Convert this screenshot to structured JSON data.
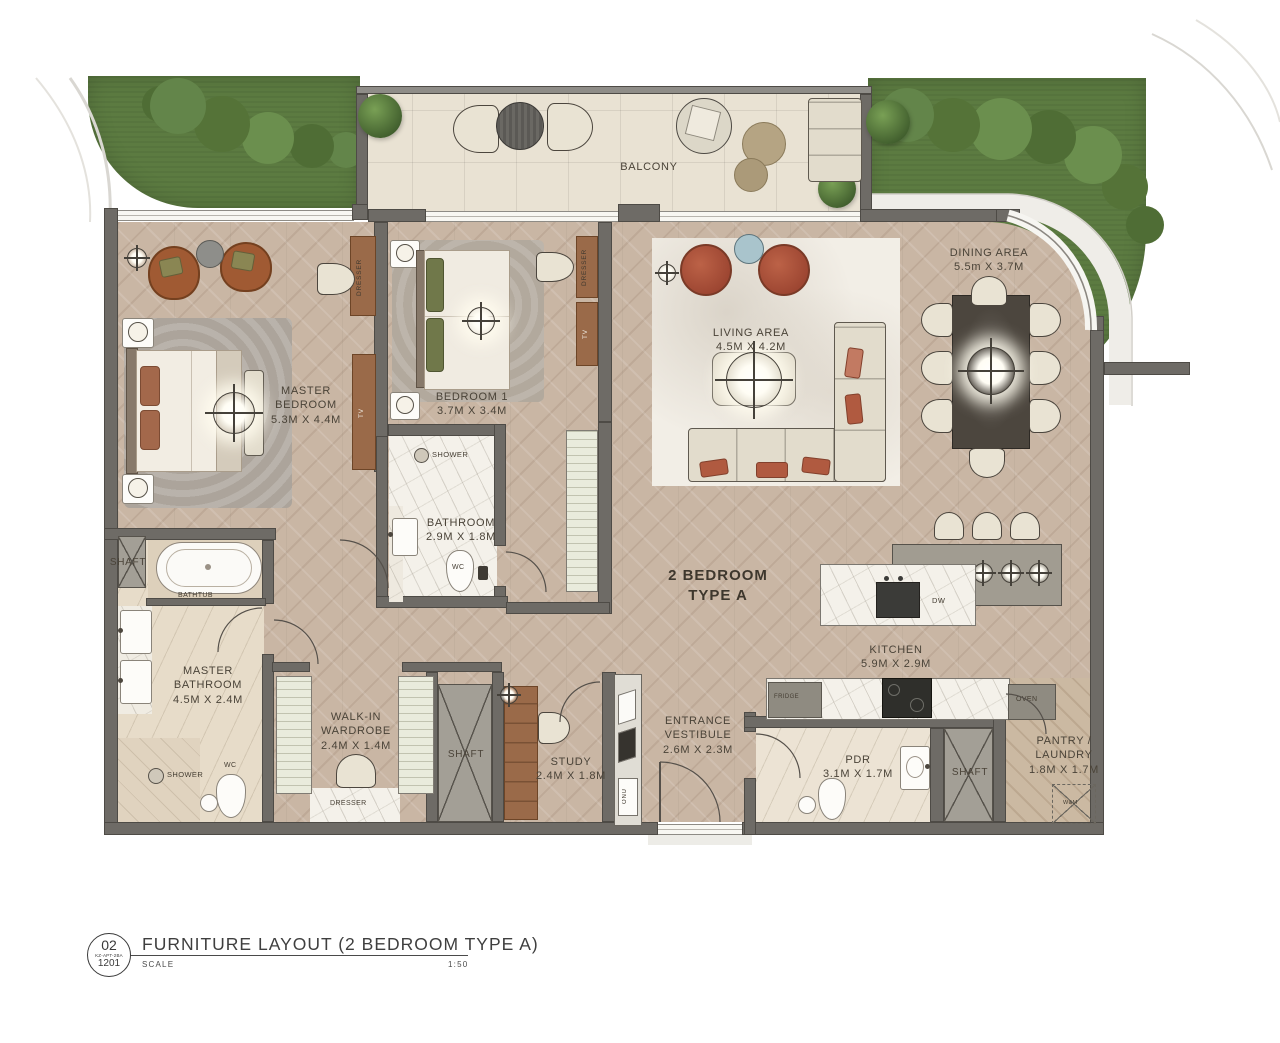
{
  "unit": {
    "type_label": "2 BEDROOM TYPE A"
  },
  "rooms": {
    "balcony": {
      "name": "BALCONY"
    },
    "master_bedroom": {
      "name": "MASTER BEDROOM",
      "dims": "5.3M X 4.4M"
    },
    "bedroom_1": {
      "name": "BEDROOM 1",
      "dims": "3.7M X 3.4M"
    },
    "living_area": {
      "name": "LIVING AREA",
      "dims": "4.5M X 4.2M"
    },
    "dining_area": {
      "name": "DINING AREA",
      "dims": "5.5m X 3.7M"
    },
    "bathroom": {
      "name": "BATHROOM",
      "dims": "2.9M X 1.8M"
    },
    "kitchen": {
      "name": "KITCHEN",
      "dims": "5.9M X 2.9M"
    },
    "master_bathroom": {
      "name": "MASTER BATHROOM",
      "dims": "4.5M X 2.4M"
    },
    "walk_in_wardrobe": {
      "name": "WALK-IN WARDROBE",
      "dims": "2.4M X 1.4M"
    },
    "study": {
      "name": "STUDY",
      "dims": "2.4M X 1.8M"
    },
    "entrance_vestibule": {
      "name": "ENTRANCE VESTIBULE",
      "dims": "2.6M X 2.3M"
    },
    "pdr": {
      "name": "PDR",
      "dims": "3.1M X 1.7M"
    },
    "pantry_laundry": {
      "name": "PANTRY / LAUNDRY",
      "dims": "1.8M X 1.7M"
    },
    "shaft": {
      "name": "SHAFT"
    }
  },
  "fixtures": {
    "shower": "SHOWER",
    "wc": "WC",
    "bathtub": "BATHTUB",
    "dresser": "DRESSER",
    "tv": "TV",
    "fridge": "FRIDGE",
    "oven": "OVEN",
    "dishwasher": "DW",
    "washing_machine": "W&M",
    "onu": "ONU"
  },
  "title_block": {
    "sheet_number": "02",
    "project_code": "KZ-APT-2BA",
    "unit_number": "1201",
    "title": "FURNITURE LAYOUT (2 BEDROOM TYPE A)",
    "scale_label": "SCALE",
    "scale_value": "1:50"
  },
  "colors": {
    "wall": "#6e6b66",
    "wood_floor": "#c9b6a4",
    "balcony_tile": "#e9e2d3",
    "landscape_green": "#5c7b41",
    "accent_terracotta": "#a34c36",
    "label_text": "#4a4338"
  }
}
